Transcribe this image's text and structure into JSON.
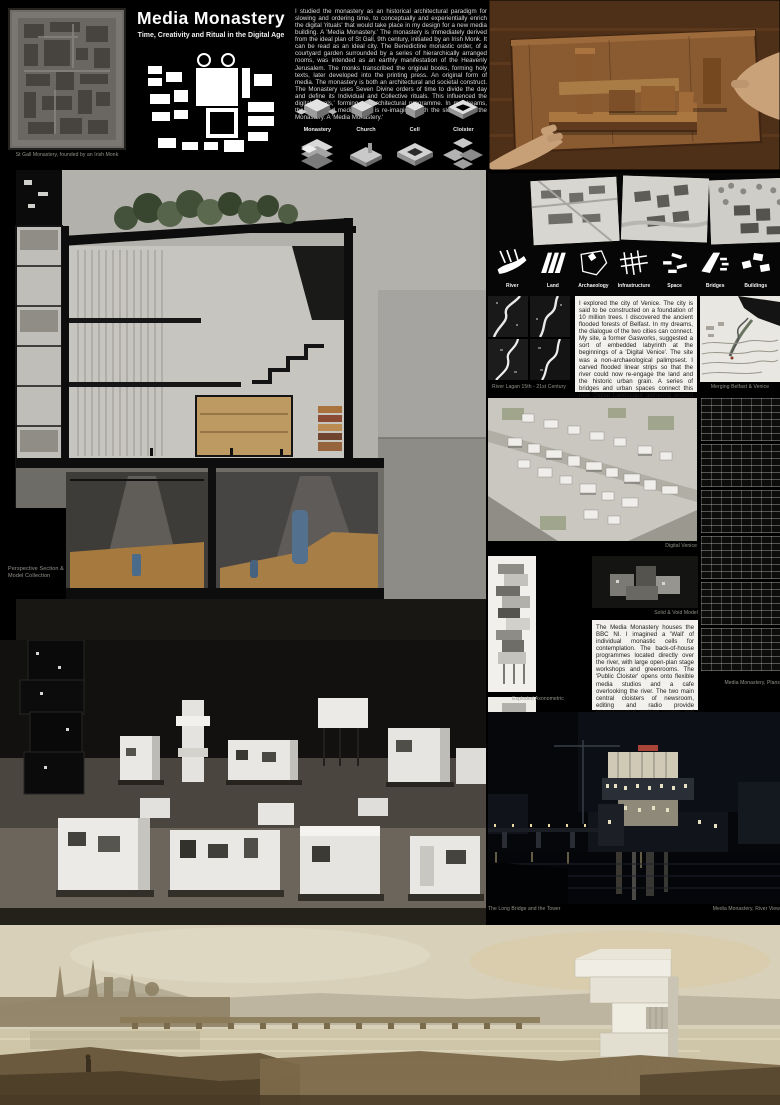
{
  "poster": {
    "title": "Media Monastery",
    "subtitle": "Time, Creativity and Ritual in the Digital Age"
  },
  "intro": "I studied the monastery as an historical architectural paradigm for slowing and ordering time, to conceptually and experientially enrich the digital 'rituals' that would take place in my design for a new media building. A 'Media Monastery.' The monastery is immediately derived from the ideal plan of St Gall, 9th century, initiated by an Irish Monk. It can be read as an ideal city. The Benedictine monastic order, of a courtyard garden surrounded by a series of hierarchically arranged rooms, was intended as an earthly manifestation of the Heavenly Jerusalem. The monks transcribed the original books, forming holy texts, later developed into the printing press. An original form of media. The monastery is both an architectural and societal construct. The Monastery uses Seven Divine orders of time to divide the day and define its Individual and Collective rituals. This influenced the digital 'rituals,' forming my architectural programme. In my dreams, the fast-paced media world is re-imagined with the slowness of the Monastery. A 'Media Monastery.'",
  "typology": [
    "Monastery",
    "Church",
    "Cell",
    "Cloister"
  ],
  "layers": [
    "River",
    "Land",
    "Archaeology",
    "Infrastructure",
    "Space",
    "Bridges",
    "Buildings"
  ],
  "texts": {
    "venice": "I explored the city of Venice. The city is said to be constructed on a foundation of 10 million trees. I discovered the ancient flooded forests of Belfast. In my dreams, the dialogue of the two cities can connect. My site, a former Gasworks, suggested a sort of embedded labyrinth at the beginnings of a 'Digital Venice'. The site was a non-archaeological palimpsest. I carved flooded linear strips so that the river could now re-engage the land and the historic urban grain. A series of bridges and urban spaces connect this new Digital Landscape gathering around the qualities of water and light. Digital offices, housing and three multifunctional media buildings in a linear pattern directly engage with the river. The archaeological remains would be exposed and create an urban park, describing the traces of history, wrapped in a Silver Birch Forest.",
    "bbc": "The Media Monastery houses the BBC NI. I imagined a 'Wall' of individual monastic cells for contemplation. The back-of-house programmes located directly over the river, with large open-plan stage workshops and greenrooms. The 'Public Cloister' opens onto flexible media studios and a cafe overlooking the river. The two main central cloisters of newsroom, editing and radio provide interconnected working spaces and chance encounters. The journey culminates in the interactive centre for Sound and Vision. A 'Sky Cloister,' restaurant and viewing platform to reconnect with the city."
  },
  "captions": {
    "st_gall": "St Gall Monastery, founded by an Irish Monk",
    "perspective_section": "Perspective Section & Model Collection",
    "river_lagan": "River Lagan 15th - 21st Century",
    "merging": "Merging Belfast & Venice",
    "digital_venice": "Digital Venice",
    "exploded_axonometric": "Exploded Axonometric",
    "solid_void": "Solid & Void Model",
    "plans": "Media Monastery, Plans",
    "long_bridge": "The Long Bridge and the Tower",
    "river_view": "Media Monastery, River View"
  },
  "colors": {
    "background": "#000000",
    "paper": "#b3b1ab",
    "wood": "#6b4423",
    "tree_green": "#45523b",
    "night": "#05070b",
    "painting_sky": "#d8d0b8"
  }
}
